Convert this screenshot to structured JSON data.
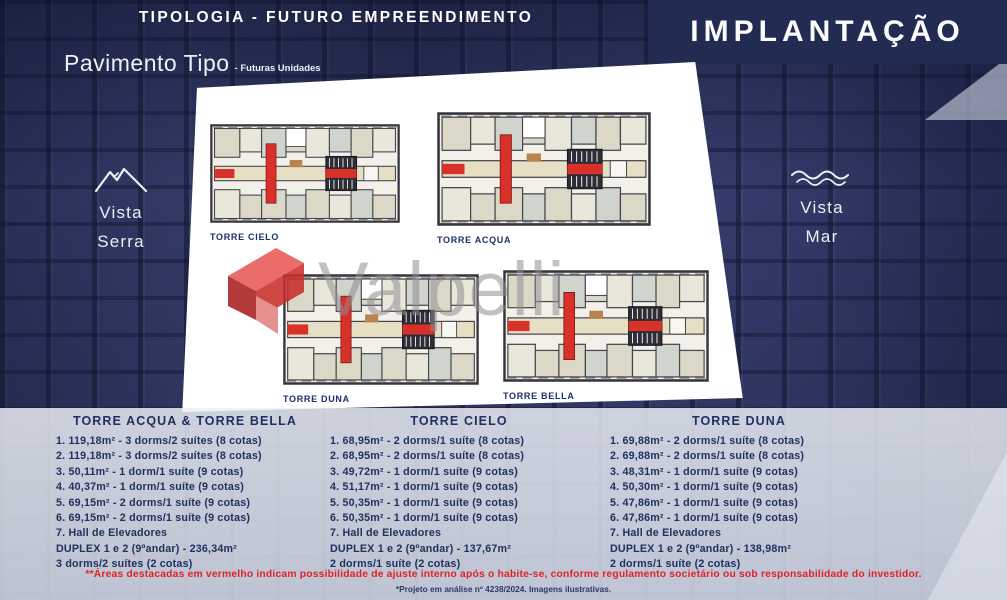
{
  "header": {
    "title": "TIPOLOGIA - FUTURO EMPREENDIMENTO",
    "panel_title": "IMPLANTAÇÃO",
    "subtitle": "Pavimento Tipo",
    "subtitle_note": "- Futuras Unidades"
  },
  "views": {
    "serra": {
      "icon": "mountain-icon",
      "line1": "Vista",
      "line2": "Serra"
    },
    "mar": {
      "icon": "waves-icon",
      "line1": "Vista",
      "line2": "Mar"
    }
  },
  "floorplans": [
    {
      "label": "TORRE CIELO"
    },
    {
      "label": "TORRE ACQUA"
    },
    {
      "label": "TORRE DUNA"
    },
    {
      "label": "TORRE BELLA"
    }
  ],
  "watermark": {
    "logo": "red-ribbon-logo",
    "text": "Valpelli"
  },
  "spec_columns": [
    {
      "title": "TORRE ACQUA & TORRE BELLA",
      "lines": [
        "1. 119,18m² - 3 dorms/2 suítes (8 cotas)",
        "2. 119,18m² - 3 dorms/2 suítes (8 cotas)",
        "3. 50,11m² - 1 dorm/1 suíte (9 cotas)",
        "4. 40,37m² - 1 dorm/1 suíte (9 cotas)",
        "5. 69,15m² - 2 dorms/1 suíte (9 cotas)",
        "6. 69,15m² - 2 dorms/1 suíte (9 cotas)",
        "7. Hall de Elevadores"
      ],
      "duplex_line1": "DUPLEX 1 e 2 (9ºandar) - 236,34m²",
      "duplex_line2": "3 dorms/2 suítes (2 cotas)"
    },
    {
      "title": "TORRE CIELO",
      "lines": [
        "1. 68,95m² - 2 dorms/1 suíte (8 cotas)",
        "2. 68,95m² - 2 dorms/1 suíte (8 cotas)",
        "3. 49,72m² - 1 dorm/1 suíte (9 cotas)",
        "4. 51,17m² - 1 dorm/1 suíte (9 cotas)",
        "5. 50,35m² - 1 dorm/1 suíte (9 cotas)",
        "6. 50,35m² - 1 dorm/1 suíte (9 cotas)",
        "7. Hall de Elevadores"
      ],
      "duplex_line1": "DUPLEX 1 e 2 (9ºandar) - 137,67m²",
      "duplex_line2": "2 dorms/1 suíte (2 cotas)"
    },
    {
      "title": "TORRE DUNA",
      "lines": [
        "1. 69,88m² - 2 dorms/1 suíte (8 cotas)",
        "2. 69,88m² - 2 dorms/1 suíte (8 cotas)",
        "3. 48,31m² - 1 dorm/1 suíte (9 cotas)",
        "4. 50,30m² - 1 dorm/1 suíte (9 cotas)",
        "5. 47,86m² - 1 dorm/1 suíte (9 cotas)",
        "6. 47,86m² - 1 dorm/1 suíte (9 cotas)",
        "7. Hall de Elevadores"
      ],
      "duplex_line1": "DUPLEX 1 e 2 (9ºandar) - 138,98m²",
      "duplex_line2": "2 dorms/1 suíte (2 cotas)"
    }
  ],
  "footer": {
    "disclaimer": "**Áreas destacadas em vermelho indicam possibilidade de ajuste interno após o habite-se, conforme regulamento societário ou sob responsabilidade do investidor.",
    "note": "*Projeto em análise nº 4238/2024. Imagens ilustrativas."
  },
  "colors": {
    "background_navy": "#2f3763",
    "panel_navy": "#222b52",
    "text_navy": "#20305f",
    "accent_red": "#d8312a",
    "disclaimer_red": "#e02127",
    "watermark_gray": "#8f8f92",
    "sheet_white": "#ffffff"
  }
}
